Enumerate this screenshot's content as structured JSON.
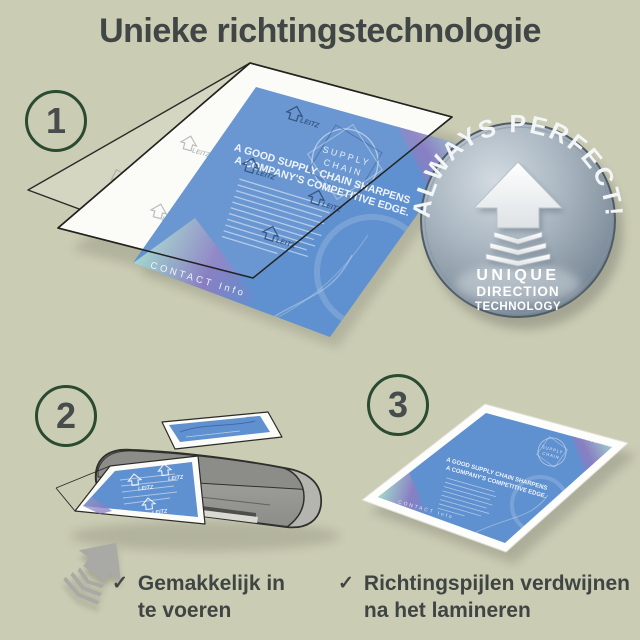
{
  "title": "Unieke richtingstechnologie",
  "colors": {
    "background": "#cbccb4",
    "title_text": "#3f4645",
    "circle_ring_green": "#2a4a31",
    "document_blue": "#5f90cf",
    "watermark_navy": "#1d3e6d",
    "badge_silver": "#97a5b2",
    "accent_teal": "#9fd4cc",
    "accent_purple": "#8b7ec2",
    "machine_gray": "#9b9b98"
  },
  "steps": [
    {
      "number": "1"
    },
    {
      "number": "2"
    },
    {
      "number": "3"
    }
  ],
  "badge": {
    "arc_text": "ALWAYS PERFECT!",
    "line1": "UNIQUE",
    "line2": "DIRECTION",
    "line3": "TECHNOLOGY"
  },
  "document": {
    "brand": "BBL CONSULTING",
    "logo_line1": "SUPPLY",
    "logo_line2": "CHAIN",
    "headline_line1": "A GOOD SUPPLY CHAIN SHARPENS",
    "headline_line2": "A COMPANY'S COMPETITIVE EDGE.",
    "footer": "CONTACT Info",
    "watermark": "LEITZ"
  },
  "checklist": [
    {
      "check": "✓",
      "line1": "Gemakkelijk in",
      "line2": "te voeren"
    },
    {
      "check": "✓",
      "line1": "Richtingspijlen verdwijnen",
      "line2": "na het lamineren"
    }
  ]
}
